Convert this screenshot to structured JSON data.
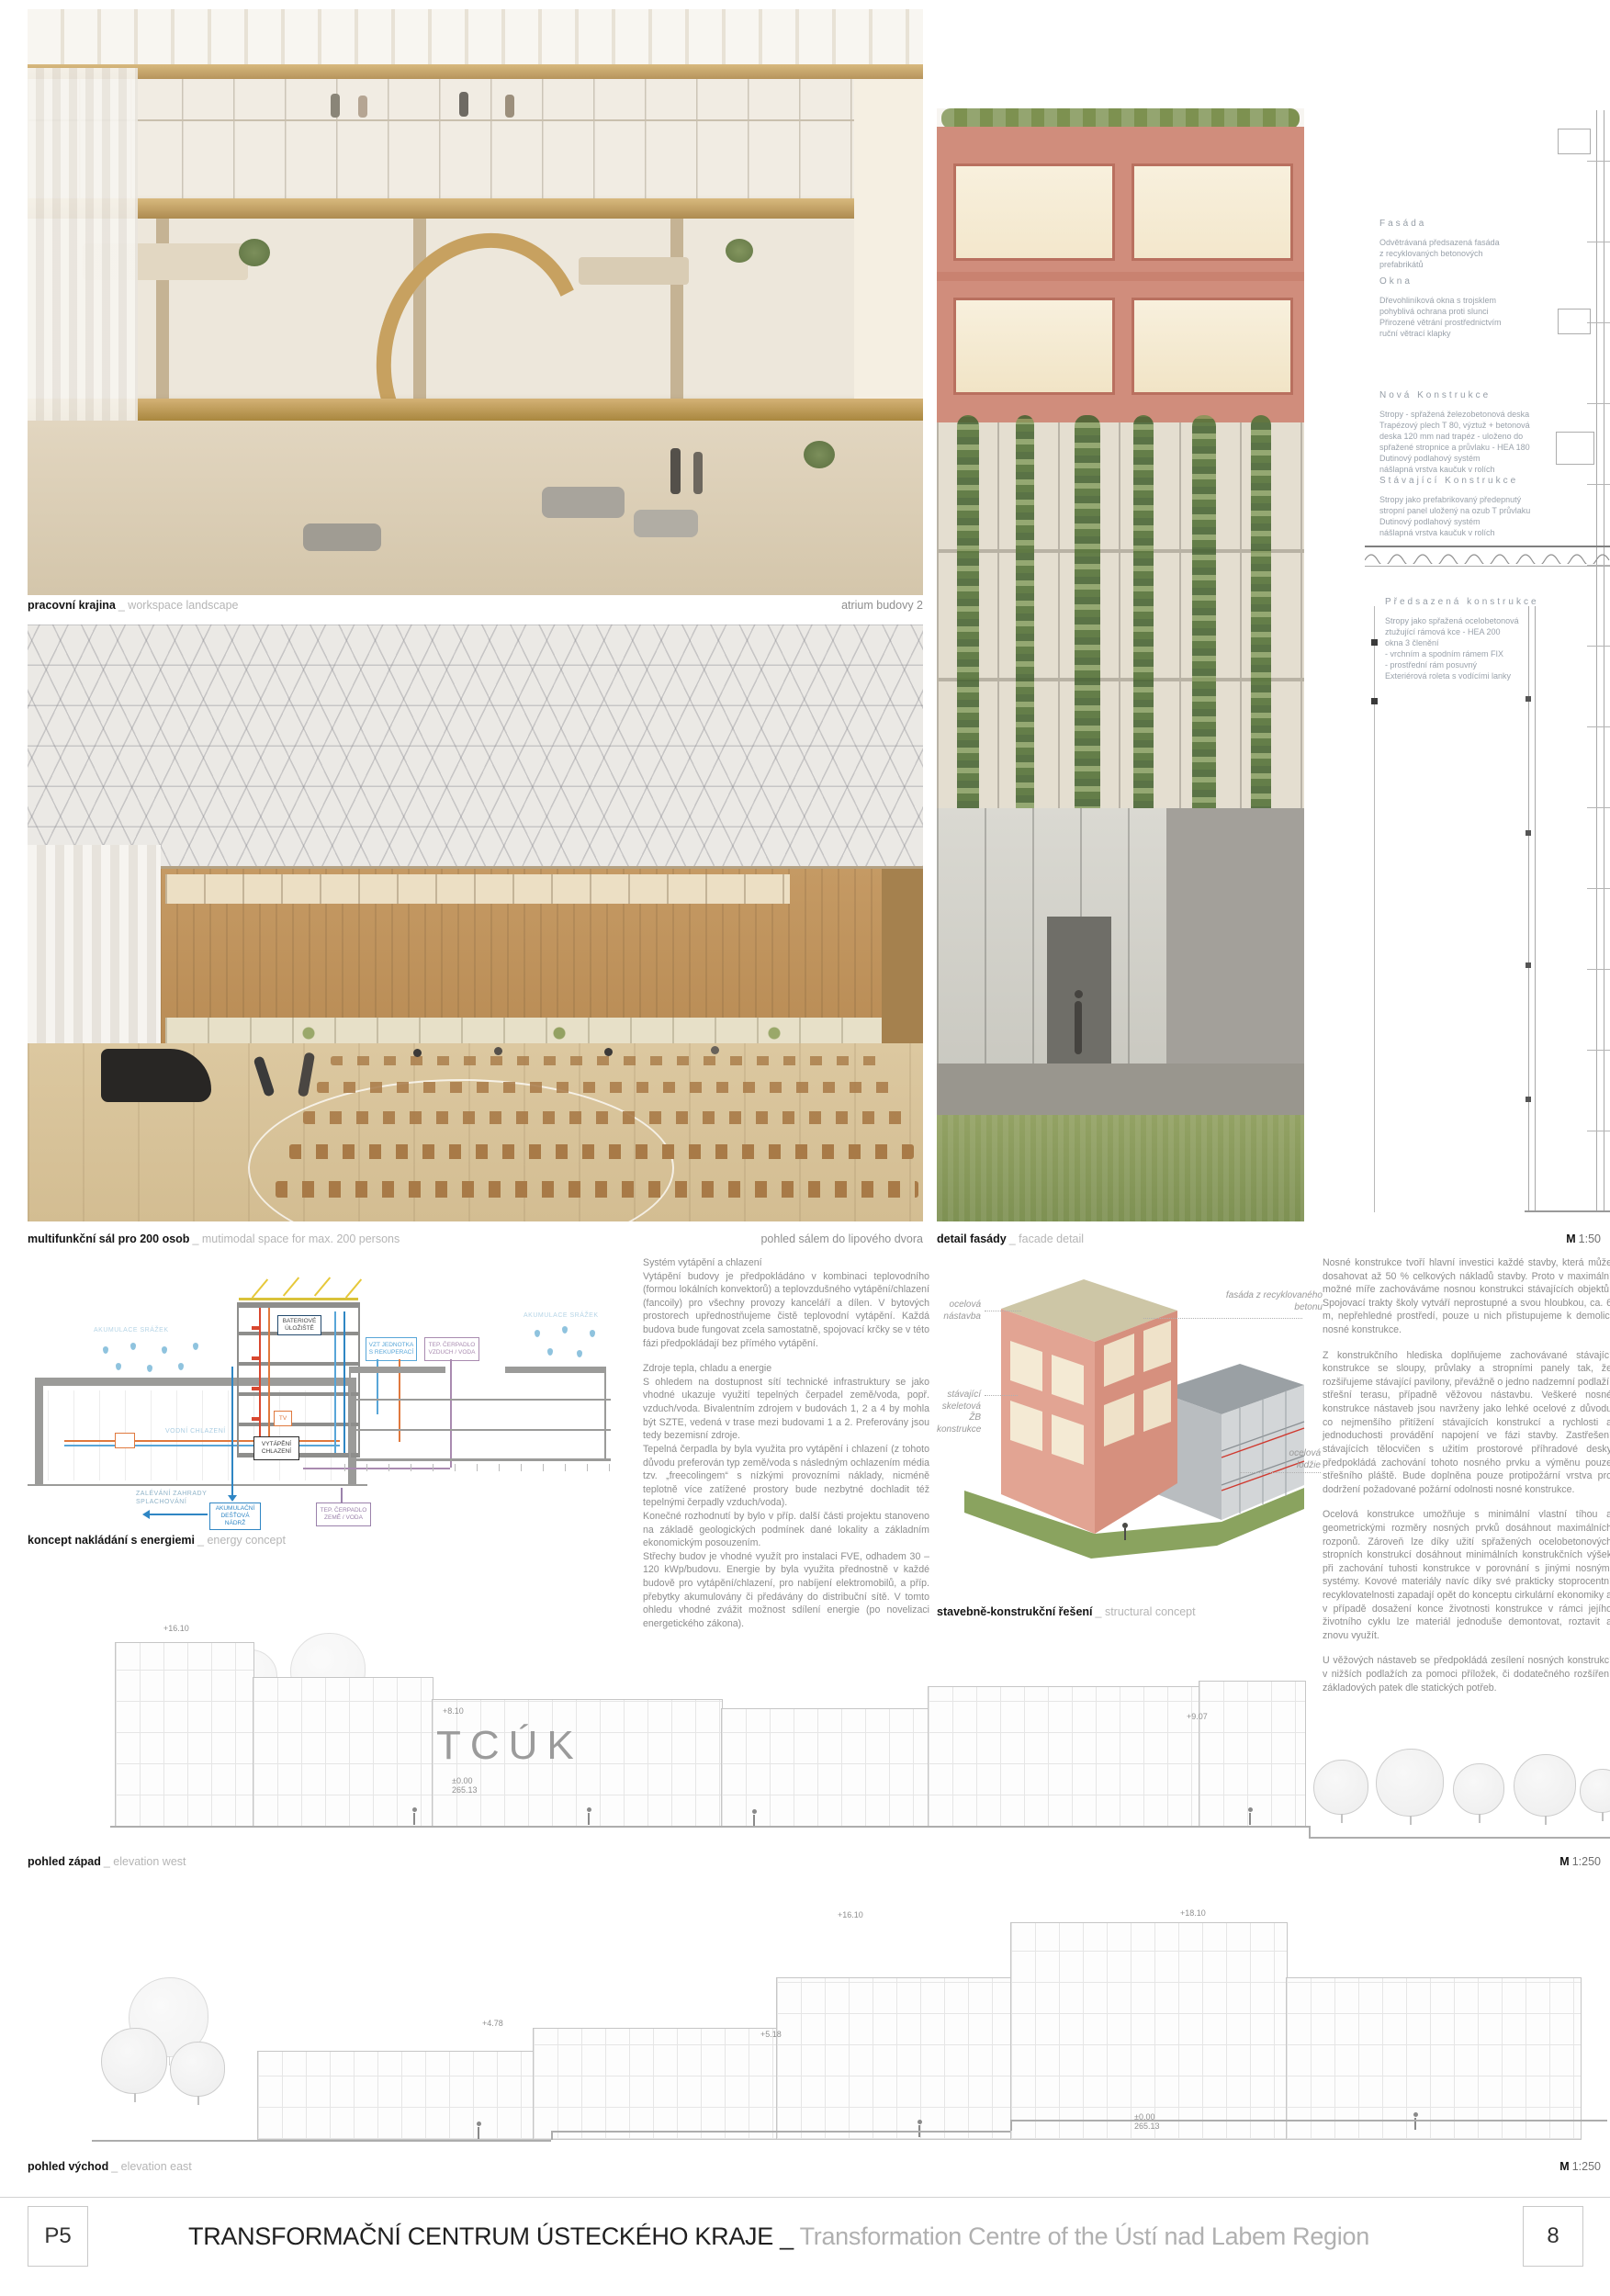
{
  "captions": {
    "workspace": {
      "title": "pracovní krajina",
      "subtitle": "_ workspace landscape",
      "right": "atrium budovy 2"
    },
    "hall": {
      "title": "multifunkční sál pro 200 osob",
      "subtitle": "_ mutimodal space for max. 200 persons",
      "right": "pohled sálem do lipového dvora"
    },
    "facade": {
      "title": "detail fasády",
      "subtitle": "_ facade detail",
      "scale_m": "M",
      "scale_v": "1:50"
    },
    "energy": {
      "title": "koncept nakládání s energiemi",
      "subtitle": "_ energy concept"
    },
    "structure": {
      "title": "stavebně-konstrukční řešení",
      "subtitle": "_ structural concept"
    },
    "west": {
      "title": "pohled západ",
      "subtitle": "_ elevation west",
      "scale_m": "M",
      "scale_v": "1:250"
    },
    "east": {
      "title": "pohled východ",
      "subtitle": "_ elevation east",
      "scale_m": "M",
      "scale_v": "1:250"
    }
  },
  "notes": {
    "sections": [
      {
        "title": "Fasáda",
        "body": "Odvětrávaná předsazená fasáda\nz recyklovaných betonových\nprefabrikátů"
      },
      {
        "title": "Okna",
        "body": "Dřevohliníková okna s trojsklem\npohyblivá ochrana proti slunci\nPřirozené větrání prostřednictvím\nruční větrací klapky"
      },
      {
        "title": "Nová Konstrukce",
        "body": "Stropy - spřažená železobetonová deska\nTrapézový plech T 80, výztuž + betonová\ndeska 120 mm nad trapéz - uloženo do\nspřažené stropnice a průvlaku - HEA 180\nDutinový podlahový systém\nnášlapná vrstva kaučuk v rolích"
      },
      {
        "title": "Stávající Konstrukce",
        "body": "Stropy jako prefabrikovaný předepnutý\nstropní panel uložený na ozub T průvlaku\nDutinový podlahový systém\nnášlapná vrstva kaučuk v rolích"
      },
      {
        "title": "Předsazená konstrukce",
        "body": "Stropy jako spřažená ocelobetonová\nztužující rámová kce - HEA 200\nokna 3 členění\n- vrchním a spodním rámem FIX\n- prostřední rám posuvný\nExteriérová roleta s vodícími lanky"
      }
    ]
  },
  "hvac": {
    "paragraphs": [
      "Systém vytápění a chlazení\nVytápění budovy je předpokládáno v kombinaci teplovodního (formou lokálních konvektorů) a teplovzdušného vytápění/chlazení (fancoily) pro všechny provozy kanceláří a dílen. V bytových prostorech upřednostňujeme čistě teplovodní vytápění. Každá budova bude fungovat zcela samostatně, spojovací krčky se v této fázi předpokládají bez přímého vytápění.",
      "Zdroje tepla, chladu a energie\nS ohledem na dostupnost sítí technické infrastruktury se jako vhodné ukazuje využití tepelných čerpadel země/voda, popř. vzduch/voda. Bivalentním zdrojem v budovách 1, 2 a 4 by mohla být SZTE, vedená v trase mezi budovami 1 a 2. Preferovány jsou tedy bezemisní zdroje.\nTepelná čerpadla by byla využita pro vytápění i chlazení (z tohoto důvodu preferován typ země/voda s následným ochlazením média tzv. „freecolingem“ s nízkými provozními náklady, nicméně teplotně více zatížené prostory bude nezbytné dochladit též tepelnými čerpadly vzduch/voda).\nKonečné rozhodnutí by bylo v příp. další části projektu stanoveno na základě geologických podmínek dané lokality a základním ekonomickým posouzením.\nStřechy budov je vhodné využít pro instalaci FVE, odhadem 30 – 120 kWp/budovu. Energie by byla využita přednostně v každé budově pro vytápění/chlazení, pro nabíjení elektromobilů, a příp. přebytky akumulovány či předávány do distribuční sítě. V tomto ohledu vhodné zvážit možnost sdílení energie (po novelizaci energetického zákona)."
    ]
  },
  "struct": {
    "paragraphs": [
      "Nosné konstrukce tvoří hlavní investici každé stavby, která může dosahovat až 50 % celkových nákladů stavby. Proto v maximální možné míře zachováváme nosnou konstrukci stávajících objektů. Spojovací trakty školy vytváří neprostupné a svou hloubkou, ca. 6 m, nepřehledné prostředí, pouze u nich přistupujeme k demolici nosné konstrukce.",
      "Z konstrukčního hlediska doplňujeme zachovávané stávající konstrukce se sloupy, průvlaky a stropními panely tak, že rozšiřujeme stávající pavilony, převážně o jedno nadzemní podlaží, střešní terasu, případně věžovou nástavbu. Veškeré nosné konstrukce nástaveb jsou navrženy jako lehké ocelové z důvodu co nejmenšího přitížení stávajících konstrukcí a rychlosti a jednoduchosti provádění napojení ve fázi stavby. Zastřešení stávajících tělocvičen s užitím prostorové příhradové desky předpokládá zachování tohoto nosného prvku a výměnu pouze střešního pláště. Bude doplněna pouze protipožární vrstva pro dodržení požadované požární odolnosti nosné konstrukce.",
      "Ocelová konstrukce umožňuje s minimální vlastní tíhou a geometrickými rozměry nosných prvků dosáhnout maximálních rozponů. Zároveň lze díky užití spřažených ocelobetonových stropních konstrukcí dosáhnout minimálních konstrukčních výšek při zachování tuhosti konstrukce v porovnání s jinými nosnými systémy. Kovové materiály navíc díky své prakticky stoprocentní recyklovatelnosti zapadají opět do konceptu cirkulární ekonomiky a v případě dosažení konce životnosti konstrukce v rámci jejího životního cyklu lze materiál jednoduše demontovat, roztavit a znovu využít.",
      "U věžových nástaveb se předpokládá zesílení nosných konstrukcí v nižších podlažích za pomoci příložek, či dodatečného rozšíření základových patek dle statických potřeb."
    ]
  },
  "energy": {
    "labels": {
      "akumulace_srazek": "AKUMULACE SRÁŽEK",
      "vodni_chlazeni": "VODNÍ CHLAZENÍ",
      "bateriove": "BATERIOVÉ\nÚLOŽIŠTĚ",
      "vytapeni": "VYTÁPĚNÍ\nCHLAZENÍ",
      "tv": "TV",
      "zalevani": "ZALÉVÁNÍ ZAHRADY\nSPLACHOVÁNÍ",
      "nadrz": "AKUMULAČNÍ\nDEŠŤOVÁ\nNÁDRŽ",
      "tc_zeme": "TEP. ČERPADLO\nZEMĚ / VODA",
      "vzt": "VZT JEDNOTKA\nS REKUPERACÍ",
      "tc_vzduch": "TEP. ČERPADLO\nVZDUCH / VODA"
    },
    "colors": {
      "blue": "#2f86c4",
      "lightblue": "#8fc3de",
      "orange": "#e0793e",
      "purple": "#9b82ab",
      "navy": "#234a6e"
    }
  },
  "axo": {
    "labels": {
      "nastavba": "ocelová\nnástavba",
      "fasada": "fasáda z recyklovaného\nbetonu",
      "stavajici": "stávající\nskeletová\nŽB konstrukce",
      "lodzie": "ocelová\nlodžie"
    }
  },
  "elev": {
    "tcuk": "TCÚK",
    "west_marks": [
      "+16.10",
      "+8.10",
      "+9.07",
      "±0.00\n265.13"
    ],
    "east_marks": [
      "+16.10",
      "+18.10",
      "+4.78",
      "+5.18",
      "±0.00\n265.13"
    ]
  },
  "footer": {
    "code": "P5",
    "title_cs": "TRANSFORMAČNÍ CENTRUM ÚSTECKÉHO KRAJE _",
    "title_en": "Transformation Centre of the Ústí nad Labem Region",
    "page": "8"
  }
}
